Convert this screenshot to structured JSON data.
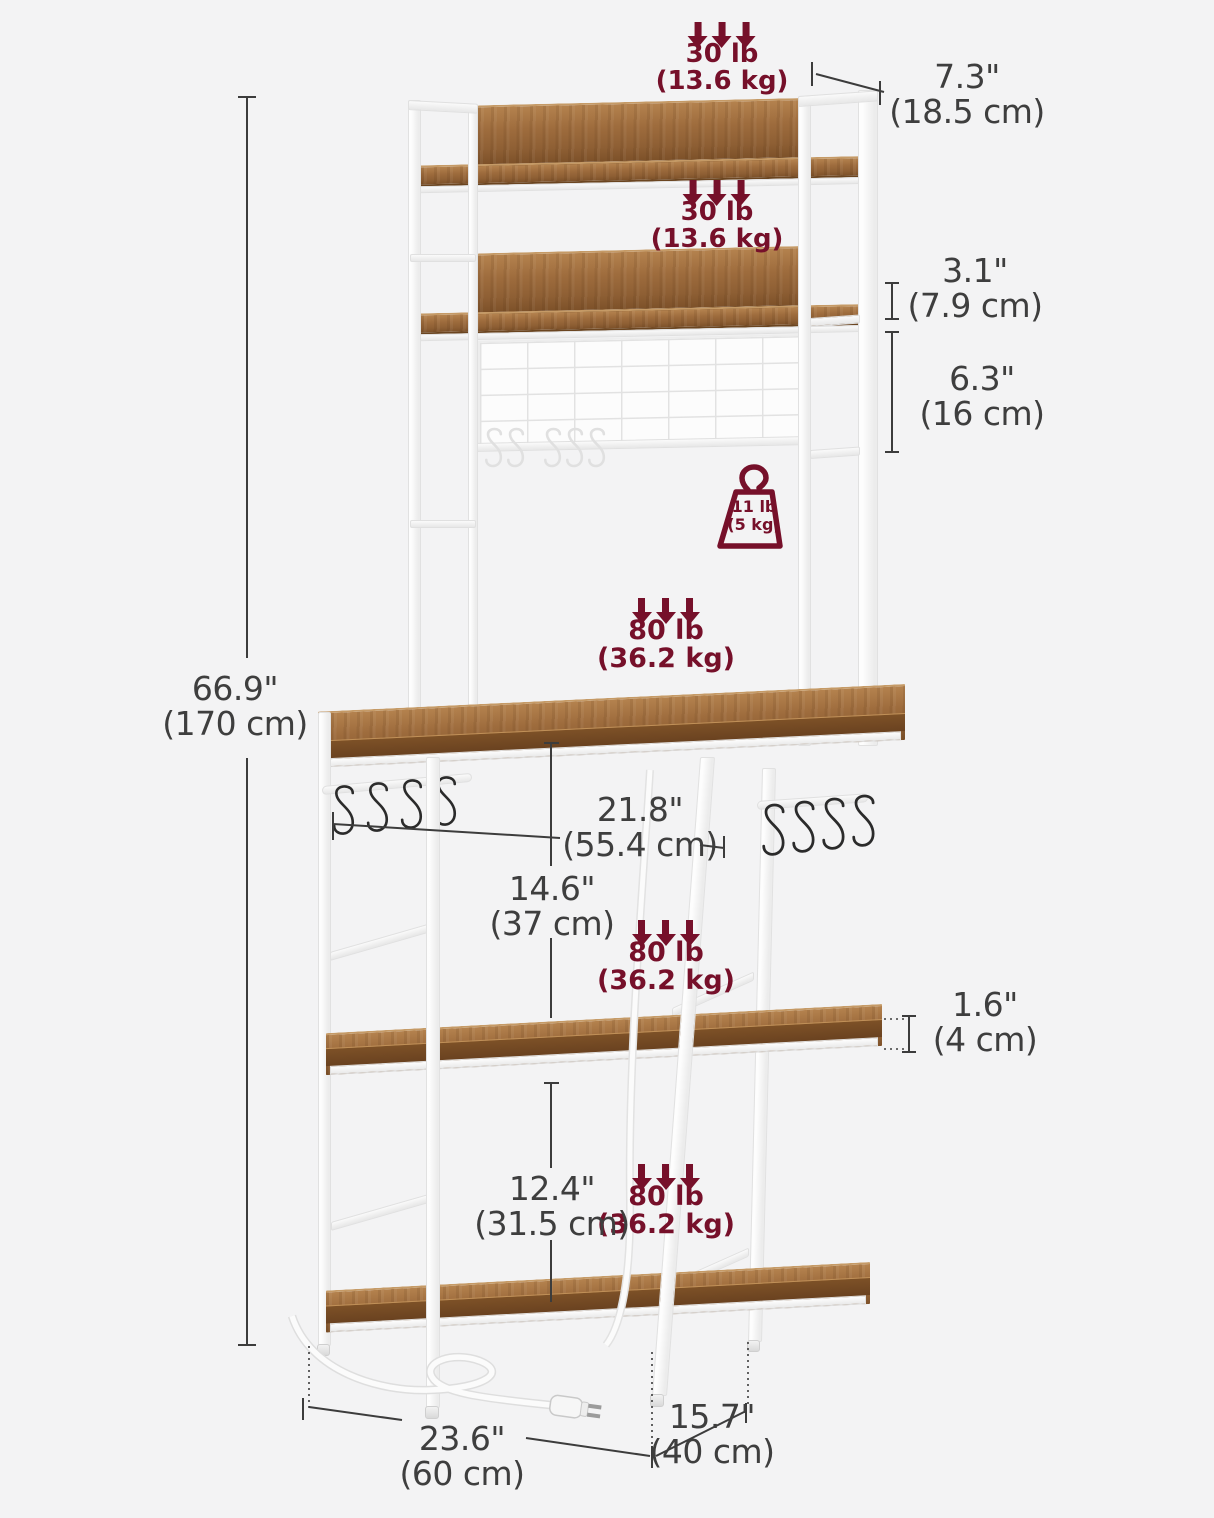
{
  "title": "Baker's rack dimension diagram",
  "colors": {
    "background": "#f3f3f4",
    "accent_maroon": "#76102a",
    "dimension_text": "#3e3e3e",
    "wood_brown": "#9e6c3d",
    "frame_white": "#fdfdfd"
  },
  "load_labels": [
    {
      "part": "top-shelf",
      "lb": "30 lb",
      "kg": "(13.6 kg)"
    },
    {
      "part": "second-shelf",
      "lb": "30 lb",
      "kg": "(13.6 kg)"
    },
    {
      "part": "main-tabletop",
      "lb": "80 lb",
      "kg": "(36.2 kg)"
    },
    {
      "part": "middle-shelf",
      "lb": "80 lb",
      "kg": "(36.2 kg)"
    },
    {
      "part": "bottom-shelf",
      "lb": "80 lb",
      "kg": "(36.2 kg)"
    }
  ],
  "hanger_load": {
    "lb": "11 lb",
    "kg": "(5 kg)"
  },
  "dimensions": [
    {
      "what": "total-height",
      "inch": "66.9\"",
      "cm": "(170 cm)"
    },
    {
      "what": "hutch-shelf-depth",
      "inch": "7.3\"",
      "cm": "(18.5 cm)"
    },
    {
      "what": "shelf-to-grid-gap",
      "inch": "3.1\"",
      "cm": "(7.9 cm)"
    },
    {
      "what": "grid-panel-height",
      "inch": "6.3\"",
      "cm": "(16 cm)"
    },
    {
      "what": "tabletop-width",
      "inch": "21.8\"",
      "cm": "(55.4 cm)"
    },
    {
      "what": "table-to-mid-shelf",
      "inch": "14.6\"",
      "cm": "(37 cm)"
    },
    {
      "what": "shelf-thickness",
      "inch": "1.6\"",
      "cm": "(4 cm)"
    },
    {
      "what": "mid-to-bottom-shelf",
      "inch": "12.4\"",
      "cm": "(31.5 cm)"
    },
    {
      "what": "overall-width",
      "inch": "23.6\"",
      "cm": "(60 cm)"
    },
    {
      "what": "overall-depth",
      "inch": "15.7\"",
      "cm": "(40 cm)"
    }
  ]
}
